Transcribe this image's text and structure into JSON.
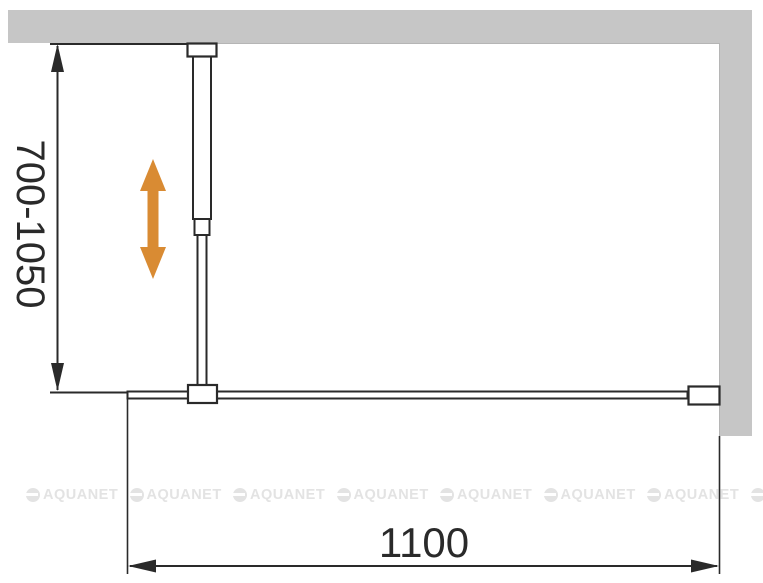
{
  "diagram": {
    "height_range_label": "700-1050",
    "width_label": "1100"
  },
  "watermark": {
    "text": "AQUANET"
  },
  "colors": {
    "wall": "#c6c6c6",
    "wall_edge": "#b5b5b5",
    "line": "#2a2a2a",
    "adjust_arrow": "#d98b33",
    "watermark": "#e3e3e3",
    "background": "#ffffff"
  }
}
